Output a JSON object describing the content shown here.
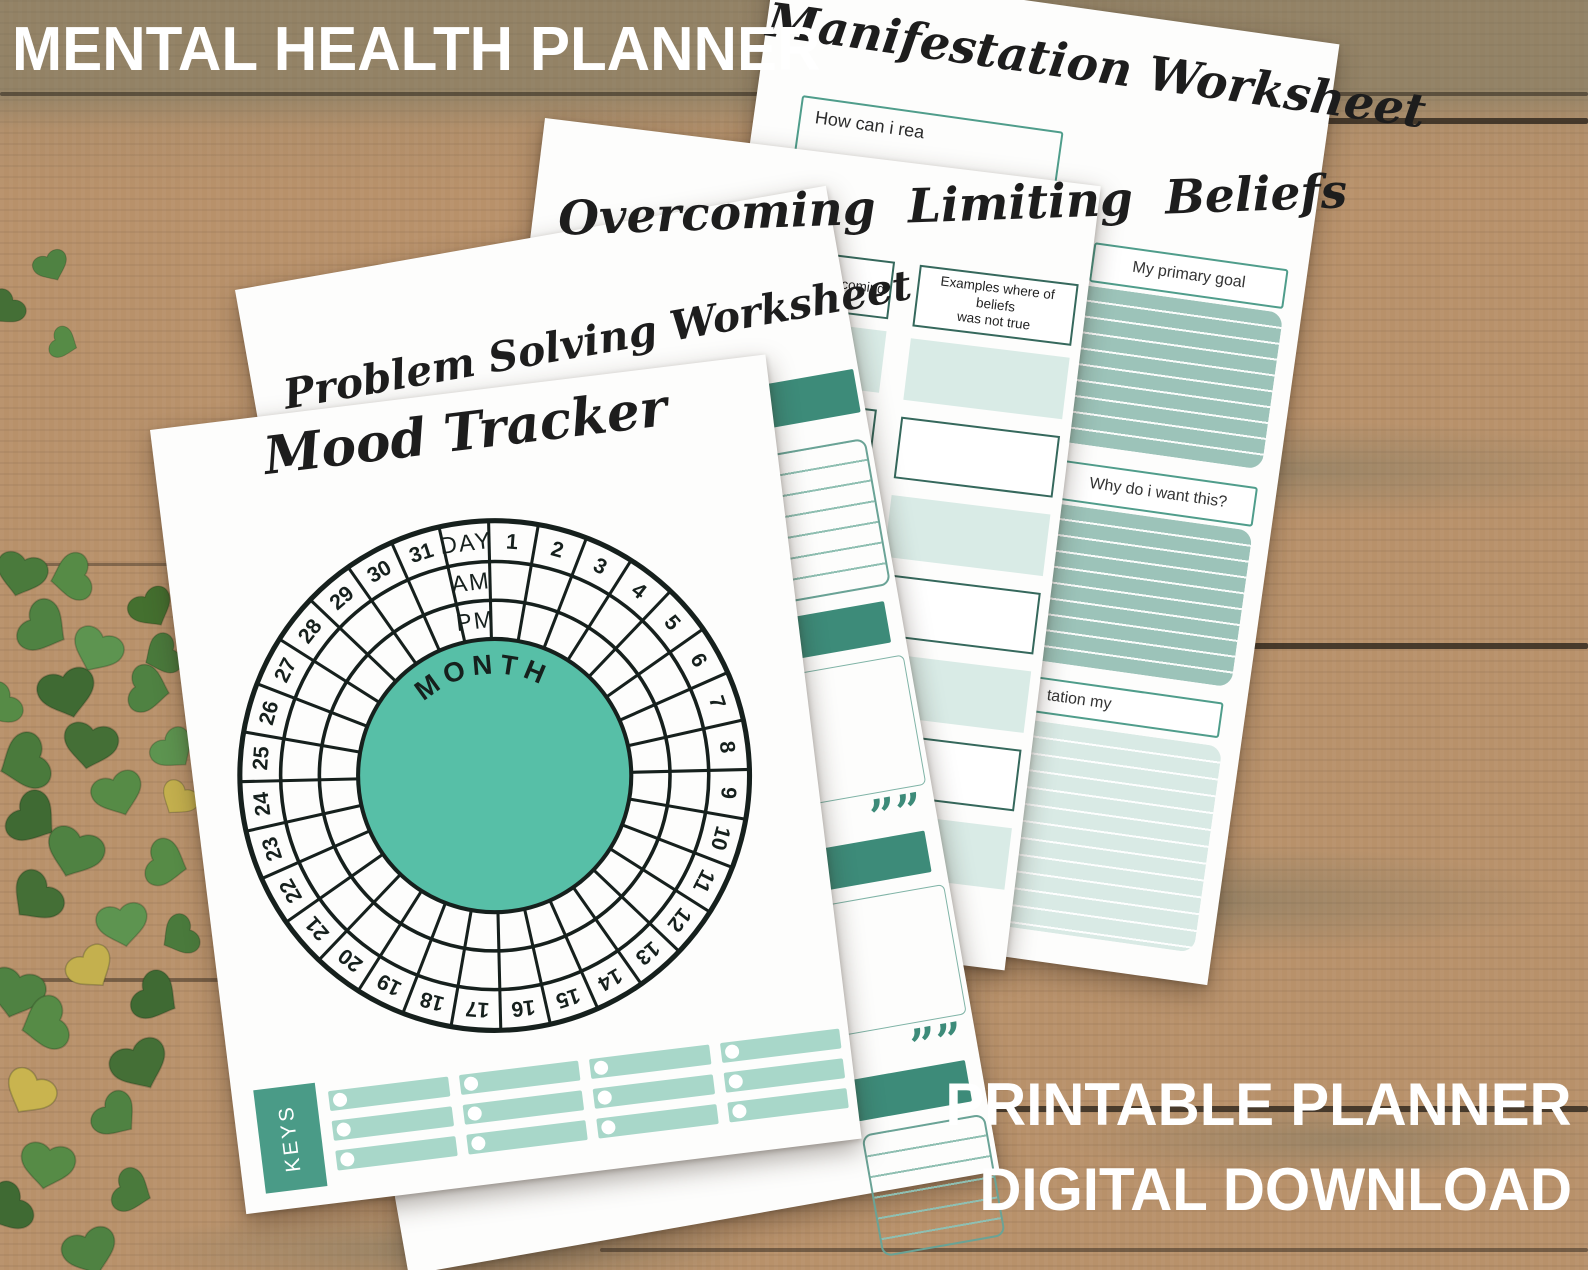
{
  "overlay": {
    "title": "MENTAL HEALTH PLANNER",
    "footer_line1": "PRINTABLE PLANNER",
    "footer_line2": "DIGITAL DOWNLOAD"
  },
  "colors": {
    "teal_dark": "#3d8b79",
    "teal_mid": "#57bfa7",
    "teal_border": "#4f9d8b",
    "dark_box_border": "#35685c",
    "mint_fill": "#d9ebe6",
    "sage_fill": "#9cc3b9",
    "light_lined_fill": "#d9eae5",
    "keys_bar": "#a8d7c9",
    "keys_label_bg": "#4a9b87",
    "ink": "#1d1d1d",
    "wood": "#b8916a"
  },
  "manifestation": {
    "title": "Manifestation Worksheet",
    "question": "How can i rea",
    "section1": "My primary goal",
    "section2": "Why do i want this?",
    "section3": "tation my"
  },
  "overcoming": {
    "title": "Overcoming Limiting Beliefs",
    "col1_header": "vercoming",
    "col2_header_line1": "Examples where of beliefs",
    "col2_header_line2": "was not true",
    "row_count": 7
  },
  "problem_solving": {
    "title": "Problem Solving Worksheet",
    "quote_mark": "””"
  },
  "mood_tracker": {
    "title": "Mood Tracker",
    "ring_labels": [
      "DAY",
      "AM",
      "PM"
    ],
    "center_label": "MONTH",
    "days": [
      1,
      2,
      3,
      4,
      5,
      6,
      7,
      8,
      9,
      10,
      11,
      12,
      13,
      14,
      15,
      16,
      17,
      18,
      19,
      20,
      21,
      22,
      23,
      24,
      25,
      26,
      27,
      28,
      29,
      30,
      31
    ],
    "keys_label": "KEYS",
    "keys_columns": 4,
    "keys_rows": 3
  }
}
